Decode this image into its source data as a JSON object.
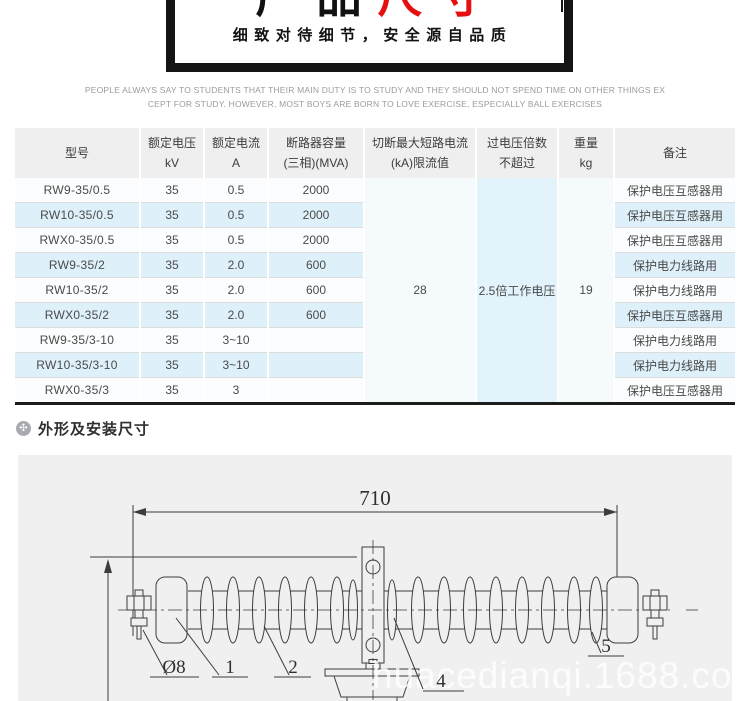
{
  "banner": {
    "title_black": "产品",
    "title_red": "尺寸",
    "subtitle": "细致对待细节，安全源自品质"
  },
  "intro": {
    "line1": "PEOPLE ALWAYS SAY TO STUDENTS THAT THEIR MAIN DUTY IS TO STUDY AND THEY SHOULD NOT SPEND TIME ON OTHER THINGS EX",
    "line2": "CEPT FOR STUDY. HOWEVER, MOST BOYS ARE BORN TO LOVE EXERCISE, ESPECIALLY BALL EXERCISES"
  },
  "table": {
    "headers": [
      {
        "l1": "型号",
        "l2": ""
      },
      {
        "l1": "额定电压",
        "l2": "kV"
      },
      {
        "l1": "额定电流",
        "l2": "A"
      },
      {
        "l1": "断路器容量",
        "l2": "(三相)(MVA)"
      },
      {
        "l1": "切断最大短路电流",
        "l2": "(kA)限流值"
      },
      {
        "l1": "过电压倍数",
        "l2": "不超过"
      },
      {
        "l1": "重量",
        "l2": "kg"
      },
      {
        "l1": "备注",
        "l2": ""
      }
    ],
    "merged": {
      "short_circuit": "28",
      "overvoltage": "2.5倍工作电压",
      "weight": "19"
    },
    "rows": [
      [
        "RW9-35/0.5",
        "35",
        "0.5",
        "2000",
        "保护电压互感器用"
      ],
      [
        "RW10-35/0.5",
        "35",
        "0.5",
        "2000",
        "保护电压互感器用"
      ],
      [
        "RWX0-35/0.5",
        "35",
        "0.5",
        "2000",
        "保护电压互感器用"
      ],
      [
        "RW9-35/2",
        "35",
        "2.0",
        "600",
        "保护电力线路用"
      ],
      [
        "RW10-35/2",
        "35",
        "2.0",
        "600",
        "保护电力线路用"
      ],
      [
        "RWX0-35/2",
        "35",
        "2.0",
        "600",
        "保护电压互感器用"
      ],
      [
        "RW9-35/3-10",
        "35",
        "3~10",
        "",
        "保护电力线路用"
      ],
      [
        "RW10-35/3-10",
        "35",
        "3~10",
        "",
        "保护电力线路用"
      ],
      [
        "RWX0-35/3",
        "35",
        "3",
        "",
        "保护电压互感器用"
      ]
    ]
  },
  "section": {
    "icon_glyph": "✣",
    "title": "外形及安装尺寸"
  },
  "drawing": {
    "dim_length": "710",
    "labels": {
      "diameter": "Ø8",
      "part1": "1",
      "part2": "2",
      "part4": "4",
      "part5": "5"
    },
    "watermark": "huacedianqi.1688.com"
  },
  "colors": {
    "accent_red": "#e60e0e",
    "row_alt_blue": "#def0fa",
    "header_gray": "#efefef",
    "drawing_bg": "#f0f0f1",
    "table_bottom_line": "#1c1c1c"
  }
}
